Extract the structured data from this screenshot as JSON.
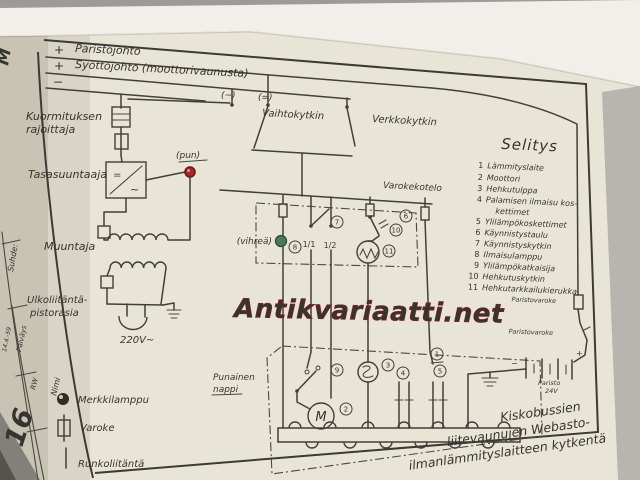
{
  "watermark": "Antikvariaatti.net",
  "buses": {
    "plus1": "+",
    "line1": "Paristojohto",
    "plus2": "+",
    "line2": "Syöttöjohto (moottorivaunusta)",
    "minus": "−"
  },
  "left": {
    "load1": "Kuormituksen",
    "load2": "rajoittaja",
    "rectifier": "Tasasuuntaaja",
    "rect_dc": "=",
    "rect_ac": "~",
    "pun": "(pun)",
    "transformer": "Muuntaja",
    "ext1": "Ulkoliitäntä-",
    "ext2": "pistorasia",
    "voltage": "220V~"
  },
  "mid": {
    "ac": "(~)",
    "dc": "(=)",
    "changeover": "Vaihtokytkin",
    "mains": "Verkkokytkin",
    "fusebox": "Varokekotelo",
    "green": "(vihreä)",
    "red1": "Punainen",
    "red2": "nappi",
    "t11": "1/1",
    "t12": "1/2",
    "motor": "M"
  },
  "legend": {
    "title": "Selitys",
    "items": [
      {
        "num": "1",
        "label": "Lämmityslaite"
      },
      {
        "num": "2",
        "label": "Moottori"
      },
      {
        "num": "3",
        "label": "Hehkutulppa"
      },
      {
        "num": "4",
        "label": "Palamisen ilmaisu kos-",
        "label2": "kettimet"
      },
      {
        "num": "5",
        "label": "Ylilämpökoskettimet"
      },
      {
        "num": "6",
        "label": "Käynnistystaulu"
      },
      {
        "num": "7",
        "label": "Käynnistyskytkin"
      },
      {
        "num": "8",
        "label": "Ilmaisulamppu"
      },
      {
        "num": "9",
        "label": "Ylilämpökatkaisija"
      },
      {
        "num": "10",
        "label": "Hehkutuskytkin"
      },
      {
        "num": "11",
        "label": "Hehkutarkkailukierukka"
      }
    ]
  },
  "symbols": {
    "lamp": "Merkkilamppu",
    "fuse": "Varoke",
    "frame_conn": "Runkoliitäntä"
  },
  "battery": {
    "fuse1": "Paristovaroke",
    "fuse2": "Paristovaroke",
    "name": "Paristo",
    "voltage": "24V",
    "plus": "+",
    "minus": "−"
  },
  "titleblock": {
    "scale": "Suhde:",
    "date": "Päiväys",
    "date_value": "14.4.-59",
    "name": "Nimi",
    "name_value": "RW",
    "page": "16",
    "margin": "M"
  },
  "caption": {
    "l1": "Kiskobussien",
    "l2": "liitevaunujen Webasto-",
    "l3": "ilmanlämmityslaitteen kytkentä"
  },
  "nums": {
    "n1": "1",
    "n2": "2",
    "n3": "3",
    "n4": "4",
    "n5": "5",
    "n6": "6",
    "n7": "7",
    "n8": "8",
    "n9": "9",
    "n10": "10",
    "n11": "11"
  }
}
